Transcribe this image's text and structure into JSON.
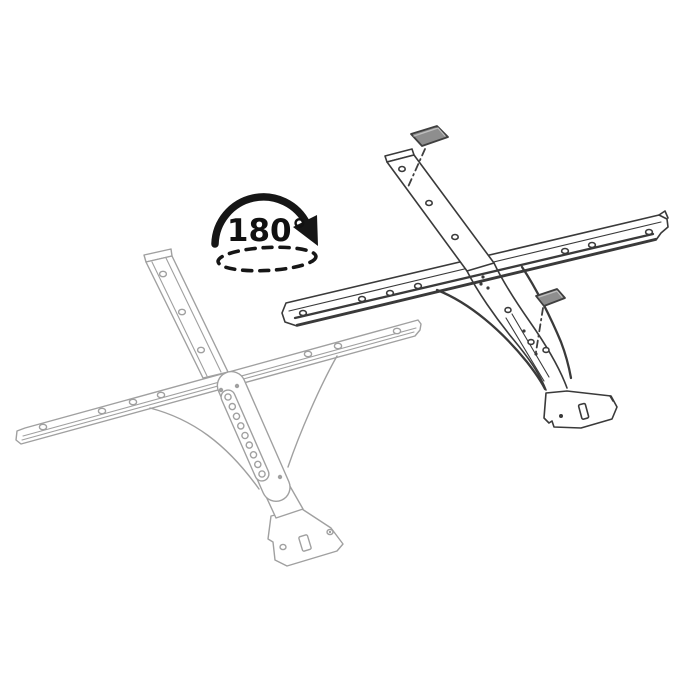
{
  "canvas": {
    "width": 700,
    "height": 700,
    "background_color": "#ffffff"
  },
  "rotation_indicator": {
    "angle_label": "180°",
    "arrow_color": "#161616",
    "label_color": "#111111",
    "axis_ellipse_style": "dashed"
  },
  "bracket_before": {
    "name": "crossbar-bracket-outline",
    "line_color": "#a0a0a0",
    "rail_hole_count": 7,
    "arm_hole_count": 3,
    "slot_hole_count": 9
  },
  "bracket_after": {
    "name": "crossbar-bracket-flipped",
    "line_color": "#3a3a3a",
    "rail_tab_count": 7,
    "arm_hole_count": 3
  },
  "spacer_pads": {
    "count": 2,
    "fill_color": "#8e8e8e",
    "edge_color": "#3f3f3f",
    "leader_line_style": "dash-dot"
  }
}
